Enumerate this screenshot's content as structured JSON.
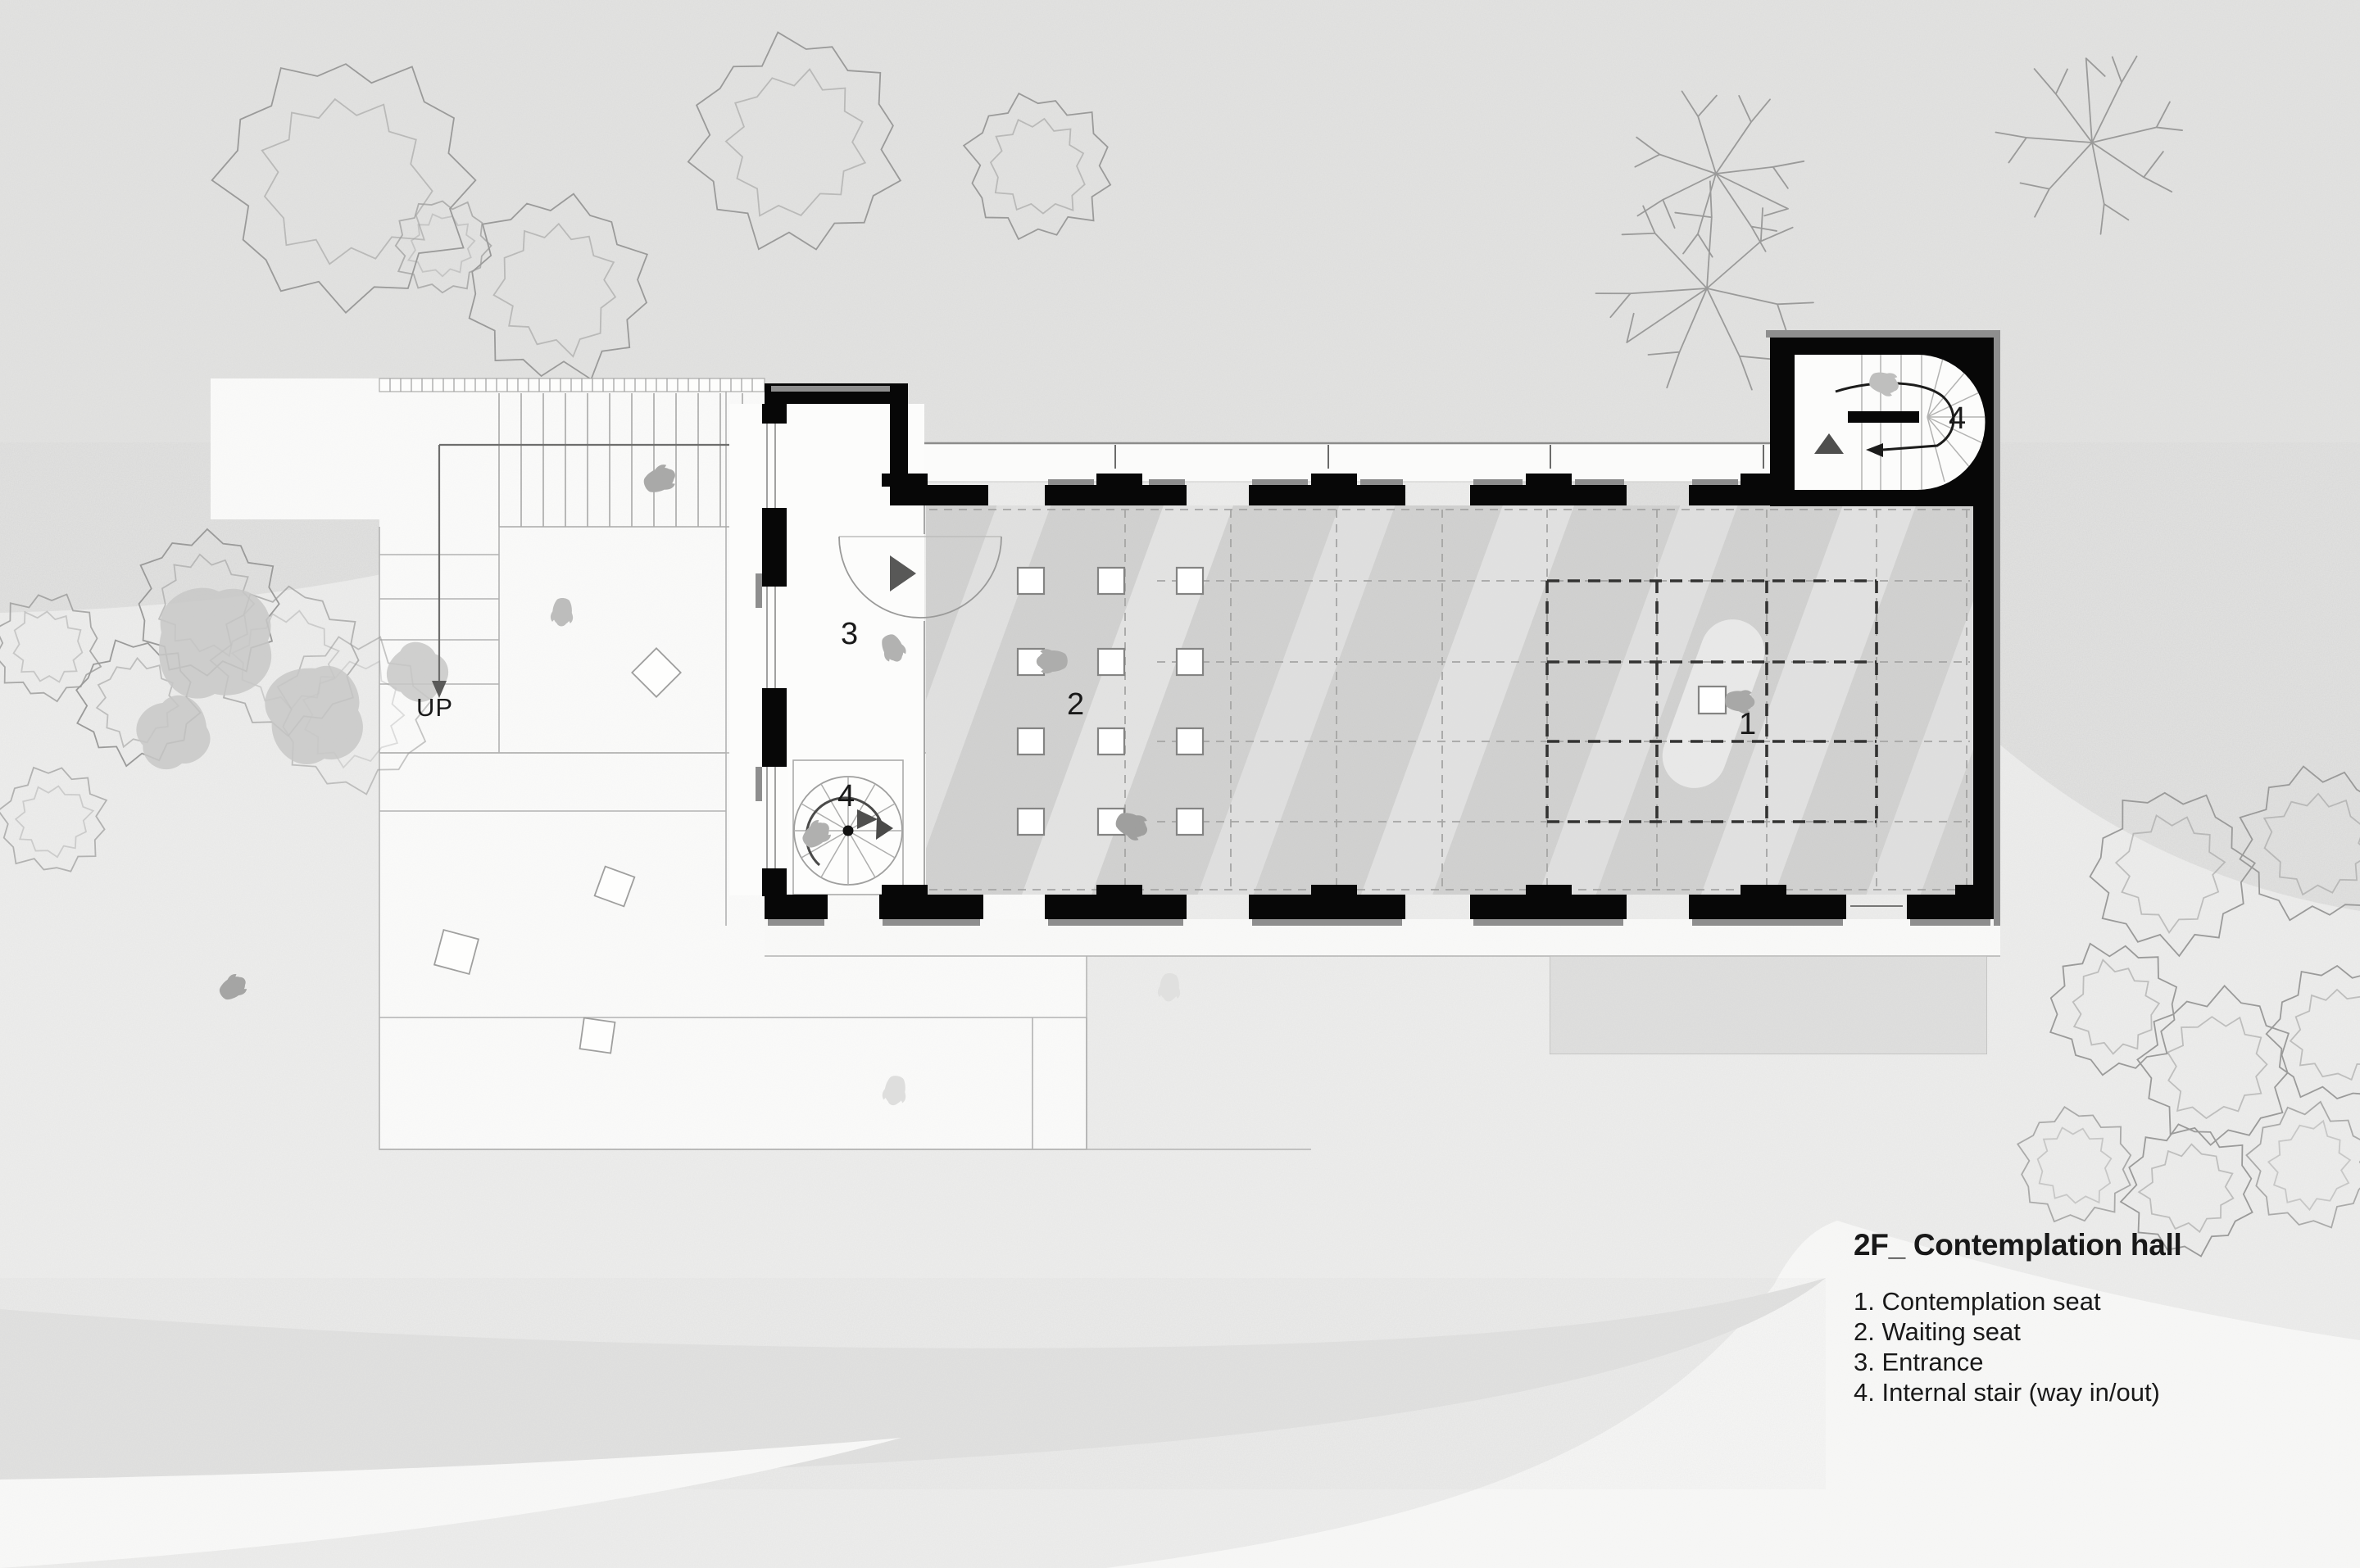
{
  "title": "2F_ Contemplation hall",
  "legend": [
    "1. Contemplation seat",
    "2. Waiting seat",
    "3. Entrance",
    "4. Internal stair (way in/out)"
  ],
  "labels": {
    "down": "DN",
    "up": "UP",
    "entrance": "3",
    "waiting": "2",
    "contemplation": "1",
    "stair_upper": "4",
    "stair_lower": "4"
  },
  "colors": {
    "background": "#e4e4e3",
    "terrain_light": "#efefee",
    "terrain_white": "#f9f9f8",
    "hall_floor": "#d3d3d2",
    "wall_black": "#070707",
    "wall_gray_cap": "#8e8e8e",
    "line_gray": "#a5a5a4",
    "text": "#191919"
  },
  "icons": {
    "person-icon": "top-view human silhouette",
    "tree-outline-icon": "scribbled plan tree canopy",
    "tree-branch-icon": "bare branching plan tree",
    "door-swing-icon": "quarter-circle door swing with direction arrow",
    "stair-arrow-icon": "stair direction arrow",
    "up-triangle-icon": "upward direction triangle"
  }
}
